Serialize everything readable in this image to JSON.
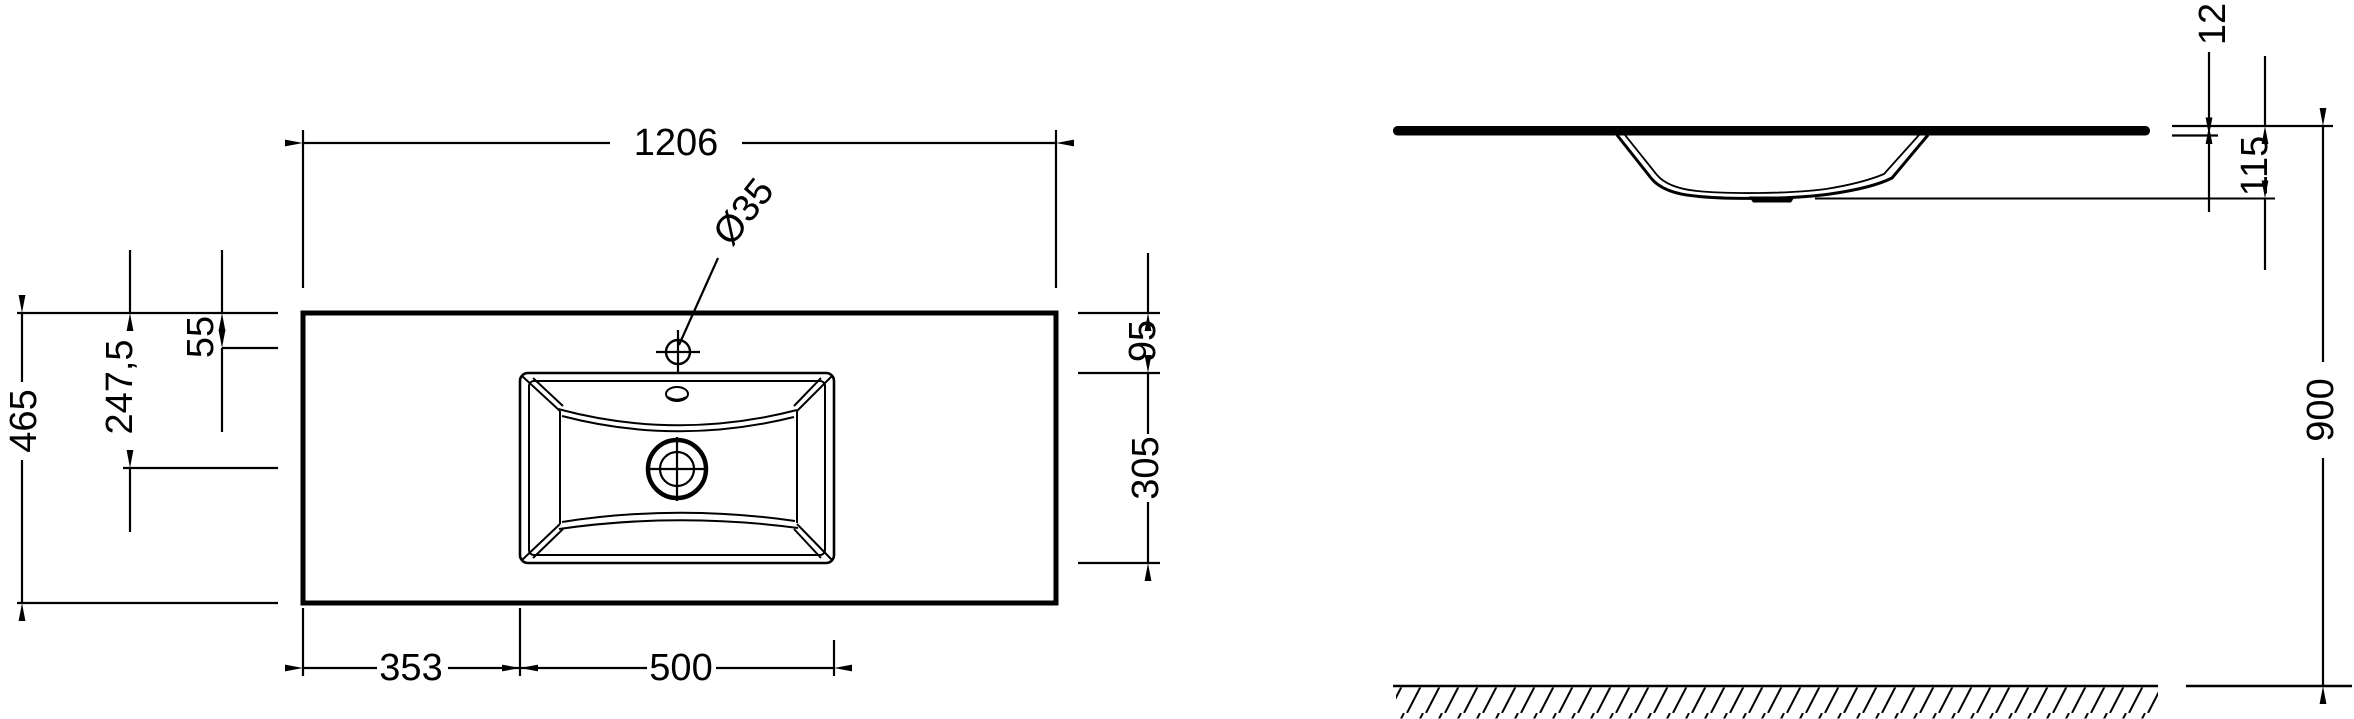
{
  "meta": {
    "background_color": "#ffffff",
    "line_color": "#000000",
    "drawing_type": "washbasin countertop dimension drawing"
  },
  "plan_view": {
    "dim_width": "1206",
    "dim_faucet_hole_diameter": "Ø35",
    "dim_faucet_offset": "55",
    "dim_drain_offset": "247,5",
    "dim_depth": "465",
    "dim_basin_top_offset": "95",
    "dim_basin_front_depth": "305",
    "dim_basin_left_offset": "353",
    "dim_basin_width": "500"
  },
  "side_view": {
    "dim_thickness": "12",
    "dim_bowl_depth": "115",
    "dim_mounting_height": "900"
  }
}
